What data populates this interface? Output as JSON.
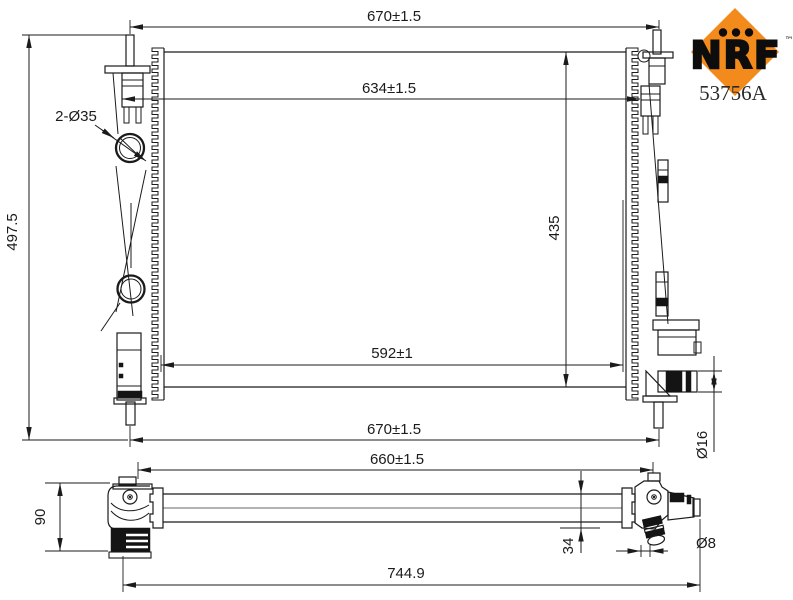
{
  "brand": {
    "name": "NRF",
    "trademark": "™",
    "part_number": "53756A",
    "logo_color": "#F28B1C",
    "logo_text_color": "#0d0d0d"
  },
  "front_view": {
    "dim_width_top": "670±1.5",
    "dim_bracket_width": "634±1.5",
    "dim_core_width": "592±1",
    "dim_width_bottom": "670±1.5",
    "dim_core_height": "435",
    "dim_overall_height": "497.5",
    "label_pipes": "2-Ø35",
    "dim_outlet_diameter": "Ø16"
  },
  "bottom_view": {
    "dim_mount_width": "660±1.5",
    "dim_overall_width": "744.9",
    "dim_end_height": "90",
    "dim_tube_depth": "34",
    "dim_drain_diameter": "Ø8"
  }
}
